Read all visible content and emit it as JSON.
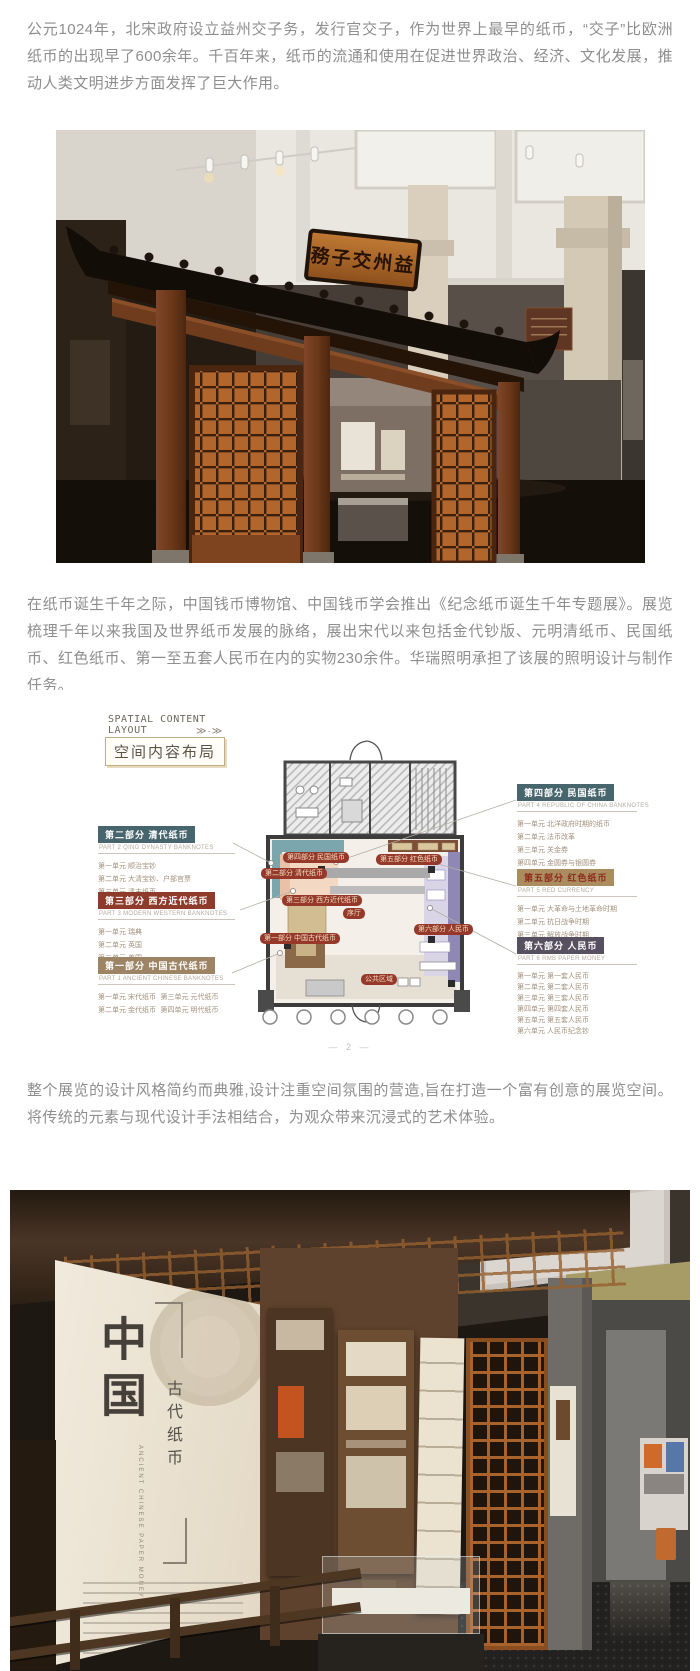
{
  "paragraphs": [
    "公元1024年，北宋政府设立益州交子务，发行官交子，作为世界上最早的纸币，“交子”比欧洲纸币的出现早了600余年。千百年来，纸币的流通和使用在促进世界政治、经济、文化发展，推动人类文明进步方面发挥了巨大作用。",
    "在纸币诞生千年之际，中国钱币博物馆、中国钱币学会推出《纪念纸币诞生千年专题展》。展览梳理千年以来我国及世界纸币发展的脉络，展出宋代以来包括金代钞版、元明清纸币、民国纸币、红色纸币、第一至五套人民币在内的实物230余件。华瑞照明承担了该展的照明设计与制作任务。",
    "整个展览的设计风格简约而典雅,设计注重空间氛围的营造,旨在打造一个富有创意的展览空间。将传统的元素与现代设计手法相结合，为观众带来沉浸式的艺术体验。"
  ],
  "photo1": {
    "plaque": "務子交州益"
  },
  "floorplan": {
    "header": {
      "line1": "SPATIAL CONTENT",
      "line2": "LAYOUT",
      "arrows": "≫·≫",
      "title": "空间内容布局"
    },
    "page_marker": "— 2 —",
    "plan_labels": {
      "hall": "序厅",
      "public": "公共区域"
    },
    "colors": {
      "pill_red": "#96392b",
      "teal": "#47656d",
      "brick": "#8e3b2b",
      "tan": "#9d8465",
      "gold": "#ab8c5e",
      "purple_zone": "#8f88b5"
    },
    "parts": [
      {
        "title": "第一部分 中国古代纸币",
        "subtitle": "PART 1 ANCIENT CHINESE BANKNOTES",
        "items": [
          "第一单元 宋代纸币",
          "第二单元 金代纸币",
          "第三单元 元代纸币",
          "第四单元 明代纸币"
        ]
      },
      {
        "title": "第二部分 清代纸币",
        "subtitle": "PART 2 QING DYNASTY BANKNOTES",
        "items": [
          "第一单元 顺治宝钞",
          "第二单元 大清宝钞、户部官票",
          "第三单元 清末纸币"
        ]
      },
      {
        "title": "第三部分 西方近代纸币",
        "subtitle": "PART 3 MODERN WESTERN BANKNOTES",
        "items": [
          "第一单元 瑞典",
          "第二单元 英国",
          "第三单元 美国"
        ]
      },
      {
        "title": "第四部分 民国纸币",
        "subtitle": "PART 4 REPUBLIC OF CHINA BANKNOTES",
        "items": [
          "第一单元 北洋政府时期的纸币",
          "第二单元 法币改革",
          "第三单元 关金券",
          "第四单元 金圆券与银圆券"
        ]
      },
      {
        "title": "第五部分 红色纸币",
        "subtitle": "PART 5 RED CURRENCY",
        "items": [
          "第一单元 大革命与土地革命时期",
          "第二单元 抗日战争时期",
          "第三单元 解放战争时期"
        ]
      },
      {
        "title": "第六部分 人民币",
        "subtitle": "PART 6 RMB PAPER MONEY",
        "items": [
          "第一单元 第一套人民币",
          "第二单元 第二套人民币",
          "第三单元 第三套人民币",
          "第四单元 第四套人民币",
          "第五单元 第五套人民币",
          "第六单元 人民币纪念钞"
        ]
      }
    ]
  },
  "photo2": {
    "title": "中国",
    "subtitle": "古代纸币",
    "english": "ANCIENT CHINESE PAPER MONEY"
  }
}
